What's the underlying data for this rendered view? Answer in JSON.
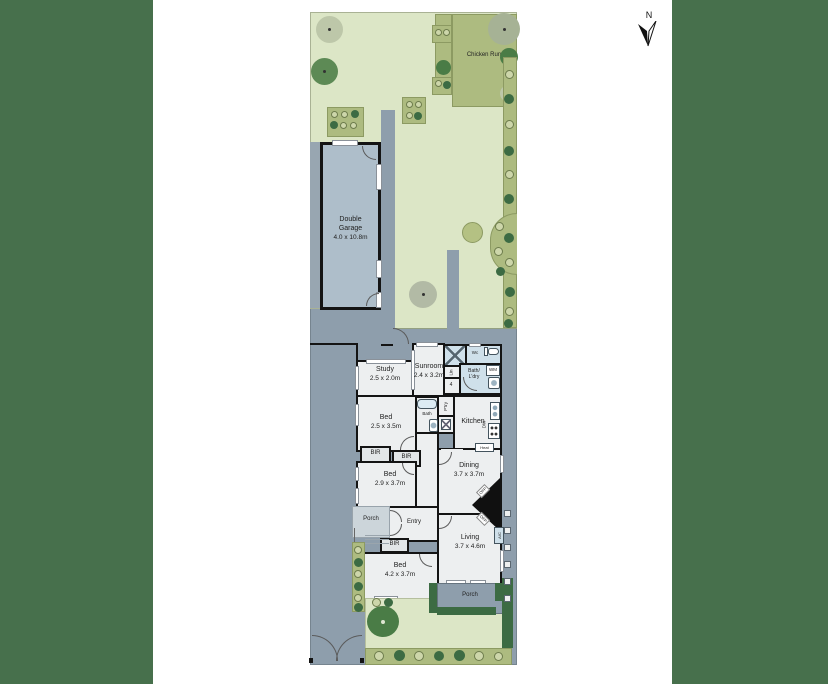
{
  "compass": {
    "label": "N"
  },
  "site": {
    "chicken_run": "Chicken Run"
  },
  "garage": {
    "name": "Double Garage",
    "dims": "4.0 x 10.8m"
  },
  "rooms": {
    "study": {
      "name": "Study",
      "dims": "2.5 x 2.0m"
    },
    "sunroom": {
      "name": "Sunroom",
      "dims": "2.4 x 3.2m"
    },
    "wc": {
      "name": "Wc"
    },
    "bath_laundry": {
      "line1": "Bath/",
      "line2": "L'dry"
    },
    "linen": {
      "name": "Lin"
    },
    "steps": {
      "count": "4"
    },
    "bed_small": {
      "name": "Bed",
      "dims": "2.5 x 3.5m"
    },
    "bath": {
      "name": "Bath"
    },
    "pantry": {
      "name": "P'try"
    },
    "kitchen": {
      "name": "Kitchen"
    },
    "dishwasher": {
      "name": "DW"
    },
    "washing_machine": {
      "name": "WM"
    },
    "heater": {
      "name": "Heat"
    },
    "bir_a": {
      "name": "BIR"
    },
    "bir_b": {
      "name": "BIR"
    },
    "bir_c": {
      "name": "BIR"
    },
    "bed_mid": {
      "name": "Bed",
      "dims": "2.9 x 3.7m"
    },
    "dining": {
      "name": "Dining",
      "dims": "3.7 x 3.7m"
    },
    "fireplace_dining": {
      "name": "OFP"
    },
    "fireplace_living": {
      "name": "OFP"
    },
    "porch_entry": {
      "name": "Porch"
    },
    "entry": {
      "name": "Entry"
    },
    "bed_front": {
      "name": "Bed",
      "dims": "4.2 x 3.7m"
    },
    "living": {
      "name": "Living",
      "dims": "3.7 x 4.6m"
    },
    "aircon": {
      "name": "A/C"
    },
    "porch_front": {
      "name": "Porch"
    }
  },
  "colors": {
    "matte": "#47704c",
    "lawn": "#dce6c6",
    "garden_bed": "#adbb80",
    "hedge": "#3c6b43",
    "paving": "#8e9eac",
    "garage": "#aebeca",
    "room": "#edeff0",
    "wet_room": "#cfe0ea",
    "wall": "#141414"
  }
}
